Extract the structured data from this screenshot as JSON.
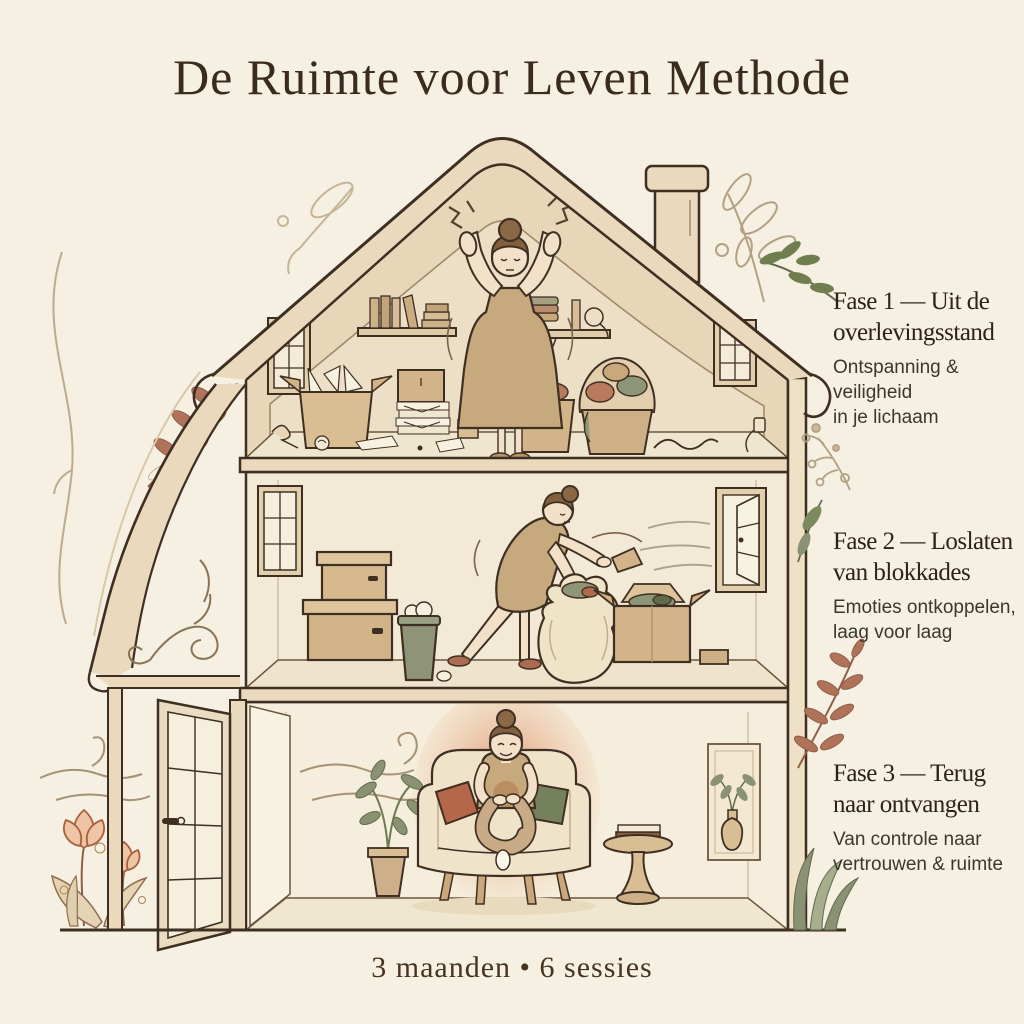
{
  "title": "De Ruimte voor Leven Methode",
  "phases": [
    {
      "heading": [
        "Fase 1 — Uit de",
        "overlevingsstand"
      ],
      "subtitle": [
        "Ontspanning &",
        "veiligheid",
        "in je lichaam"
      ]
    },
    {
      "heading": [
        "Fase 2 — Loslaten",
        "van blokkades"
      ],
      "subtitle": [
        "Emoties ontkoppelen,",
        "laag voor laag"
      ]
    },
    {
      "heading": [
        "Fase 3 — Terug",
        "naar ontvangen"
      ],
      "subtitle": [
        "Van controle naar",
        "vertrouwen & ruimte"
      ]
    }
  ],
  "footer": "3 maanden • 6 sessies",
  "colors": {
    "background": "#f5f0e1",
    "outline": "#3f2f23",
    "roof_band": "#ead9bc",
    "attic_wall": "#e7d6b8",
    "room_wall": "#f2e9d6",
    "cardboard": "#d2b488",
    "terracotta": "#b5674a",
    "sage_green": "#8b9274",
    "glow_orange": "#e08a5f",
    "skin": "#f2e1c8",
    "hair_brown": "#82603e",
    "dress_tan": "#c7a97e",
    "title_text": "#3b2b1c"
  }
}
